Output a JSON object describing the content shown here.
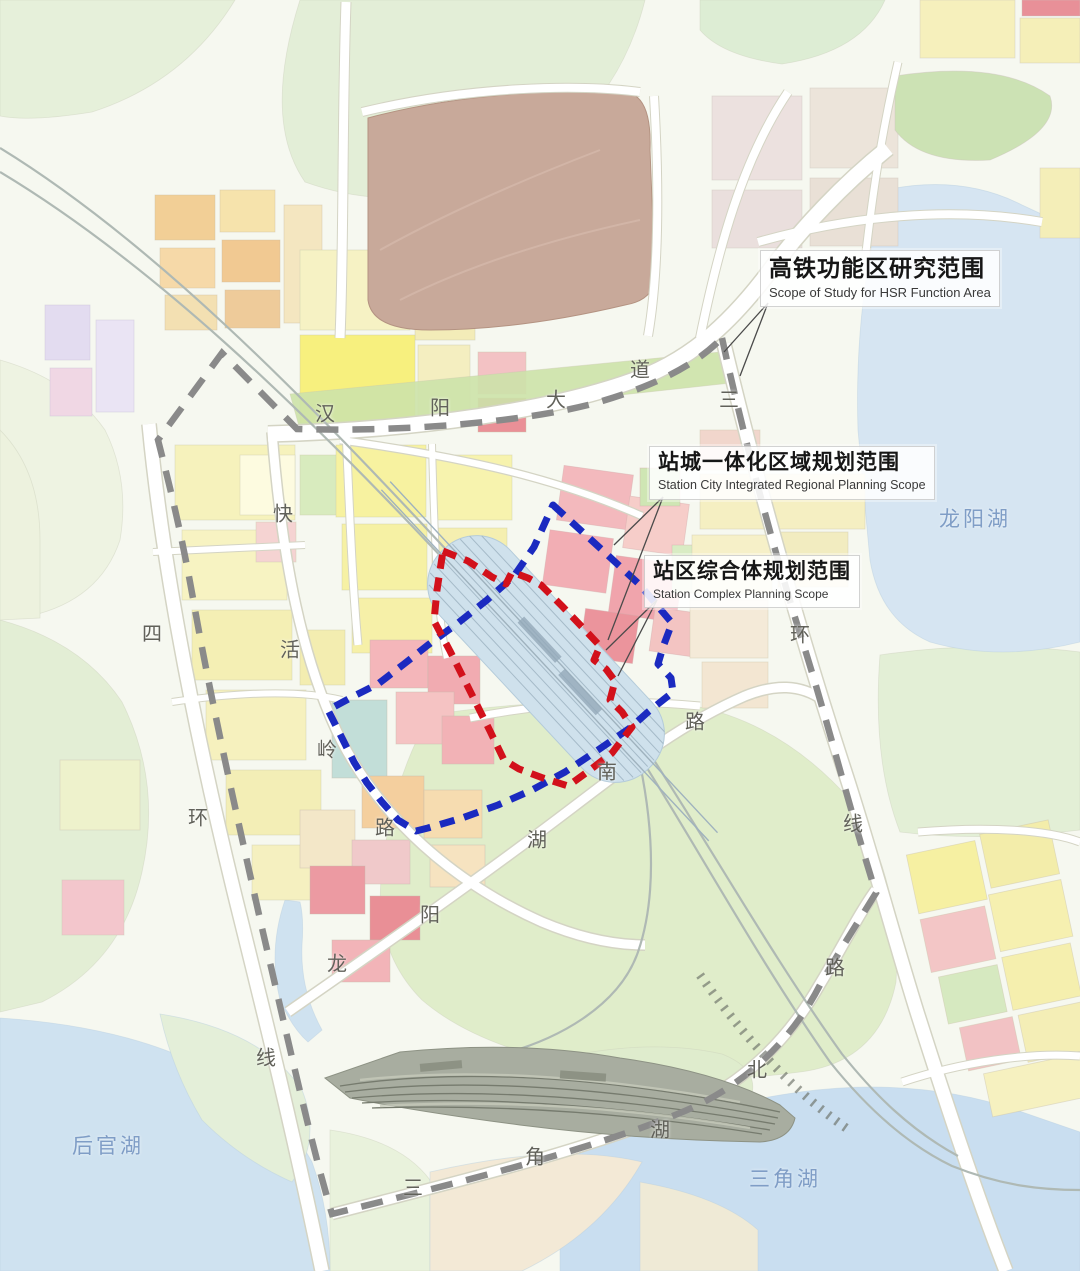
{
  "map": {
    "callouts": [
      {
        "zh": "高铁功能区研究范围",
        "en": "Scope of Study for HSR Function Area",
        "color": "#8a8a8a",
        "line_style": "dashed"
      },
      {
        "zh": "站城一体化区域规划范围",
        "en": "Station City Integrated Regional Planning Scope",
        "color": "#1b2ac0",
        "line_style": "dashed"
      },
      {
        "zh": "站区综合体规划范围",
        "en": "Station Complex Planning Scope",
        "color": "#d2111b",
        "line_style": "dashed"
      }
    ],
    "road_labels": [
      {
        "name": "汉阳大道",
        "chars": [
          {
            "ch": "汉",
            "x": 325,
            "y": 412
          },
          {
            "ch": "阳",
            "x": 440,
            "y": 406
          },
          {
            "ch": "大",
            "x": 556,
            "y": 398
          },
          {
            "ch": "道",
            "x": 640,
            "y": 368
          }
        ]
      },
      {
        "name": "三环线",
        "chars": [
          {
            "ch": "三",
            "x": 729,
            "y": 398
          },
          {
            "ch": "环",
            "x": 800,
            "y": 633
          },
          {
            "ch": "线",
            "x": 853,
            "y": 822
          }
        ]
      },
      {
        "name": "四环线",
        "chars": [
          {
            "ch": "四",
            "x": 152,
            "y": 632
          },
          {
            "ch": "环",
            "x": 198,
            "y": 816
          },
          {
            "ch": "线",
            "x": 266,
            "y": 1056
          }
        ]
      },
      {
        "name": "快活岭路",
        "chars": [
          {
            "ch": "快",
            "x": 283,
            "y": 512
          },
          {
            "ch": "活",
            "x": 290,
            "y": 648
          },
          {
            "ch": "岭",
            "x": 327,
            "y": 748
          },
          {
            "ch": "路",
            "x": 385,
            "y": 826
          }
        ]
      },
      {
        "name": "龙阳湖南路",
        "chars": [
          {
            "ch": "龙",
            "x": 337,
            "y": 962
          },
          {
            "ch": "阳",
            "x": 430,
            "y": 913
          },
          {
            "ch": "湖",
            "x": 537,
            "y": 838
          },
          {
            "ch": "南",
            "x": 607,
            "y": 770
          },
          {
            "ch": "路",
            "x": 695,
            "y": 720
          }
        ]
      },
      {
        "name": "三角湖北路",
        "chars": [
          {
            "ch": "三",
            "x": 413,
            "y": 1186
          },
          {
            "ch": "角",
            "x": 535,
            "y": 1155
          },
          {
            "ch": "湖",
            "x": 660,
            "y": 1128
          },
          {
            "ch": "北",
            "x": 757,
            "y": 1068
          },
          {
            "ch": "路",
            "x": 835,
            "y": 966
          }
        ]
      }
    ],
    "lake_labels": [
      {
        "name": "龙阳湖",
        "x": 975,
        "y": 518
      },
      {
        "name": "后官湖",
        "x": 108,
        "y": 1145
      },
      {
        "name": "三角湖",
        "x": 785,
        "y": 1178
      }
    ]
  }
}
